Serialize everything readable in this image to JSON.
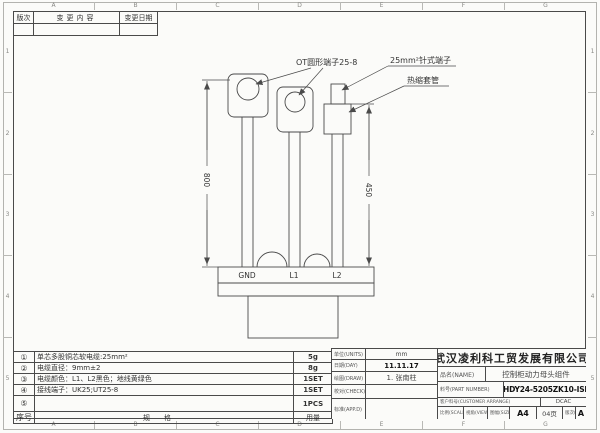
{
  "sheet": {
    "zones_letters": [
      "A",
      "B",
      "C",
      "D",
      "E",
      "F",
      "G"
    ],
    "zones_numbers": [
      "1",
      "2",
      "3",
      "4",
      "5"
    ]
  },
  "revision": {
    "headers": [
      "版次",
      "变更内容",
      "变更日期"
    ]
  },
  "drawing": {
    "annotations": {
      "ot": "OT圆形端子25-8",
      "pin": "25mm²针式端子",
      "shrink": "热缩套管"
    },
    "dimensions": {
      "left": "800",
      "right": "450"
    },
    "connector_labels": [
      "GND",
      "L1",
      "L2"
    ]
  },
  "bom": {
    "rows": [
      {
        "no": "①",
        "spec": "单芯多股铜芯软电缆:25mm²",
        "qty": "5g"
      },
      {
        "no": "②",
        "spec": "电缆直径：9mm±2",
        "qty": "8g"
      },
      {
        "no": "③",
        "spec": "电缆颜色：L1、L2黑色；地线黄绿色",
        "qty": "1SET"
      },
      {
        "no": "④",
        "spec": "接线端子：UK25;UT25-8",
        "qty": "1SET"
      },
      {
        "no": "⑤",
        "spec": "",
        "qty": "1PCS"
      }
    ],
    "footer": {
      "no": "序号",
      "spec": "规格",
      "qty": "用量"
    }
  },
  "title_block": {
    "company": "武汉凌利科工贸发展有限公司",
    "rows": [
      {
        "label": "单位(UNITS)",
        "value": "mm"
      },
      {
        "label": "日期(DAY)",
        "value": "11.11.17"
      },
      {
        "label": "绘图(DRAW)",
        "value": "1. 张南柱"
      },
      {
        "label": "校对(CHECK)",
        "value": ""
      },
      {
        "label": "标准(APP.D)",
        "value": ""
      }
    ],
    "name_label": "品名(NAME)",
    "name_value": "控制柜动力母头组件",
    "part_label": "料号(PART NUMBER)",
    "part_value": "HDY24-5205ZK10-ISI",
    "customer_label": "客户料号(CUSTOMER ARRANGE)",
    "customer_value": "DCAC",
    "scale_label": "比例(SCALE)",
    "view_label": "视角(VIEW)",
    "size_label": "图幅(SIZE)",
    "size_value": "A4",
    "page_value": "04页",
    "rev_label": "版次(REV)",
    "rev_value": "A"
  }
}
